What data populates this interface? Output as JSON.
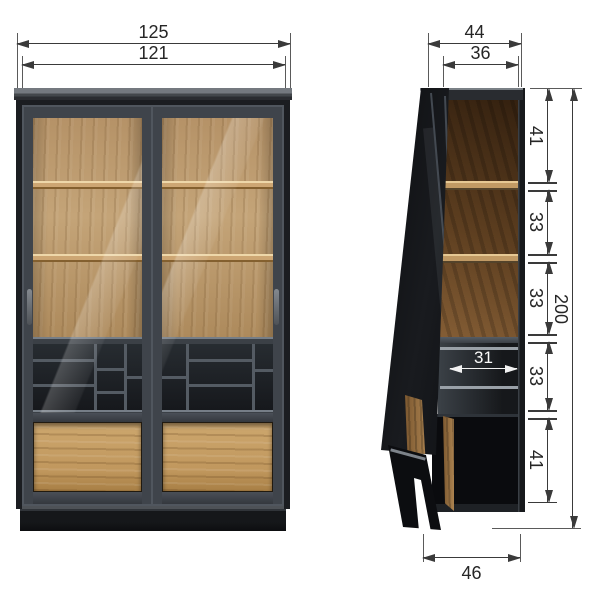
{
  "front_view": {
    "outer_width": "125",
    "inner_width": "121"
  },
  "side_view": {
    "outer_depth_top": "44",
    "inner_depth_top": "36",
    "total_height": "200",
    "height_segments": [
      "41",
      "33",
      "33",
      "33",
      "41"
    ],
    "interior_depth": "31",
    "base_depth": "46"
  },
  "colors": {
    "background": "#ffffff",
    "dimension_line": "#3a3a3a",
    "label_text": "#262626",
    "white_dimension": "#f2f2f2",
    "cabinet_frame_black": "#1b1d21",
    "door_frame_gray": "#3f444b",
    "oak_wood": "#c2a074",
    "walnut_wood": "#7b5a34",
    "interior_dark": "#1e2226"
  }
}
